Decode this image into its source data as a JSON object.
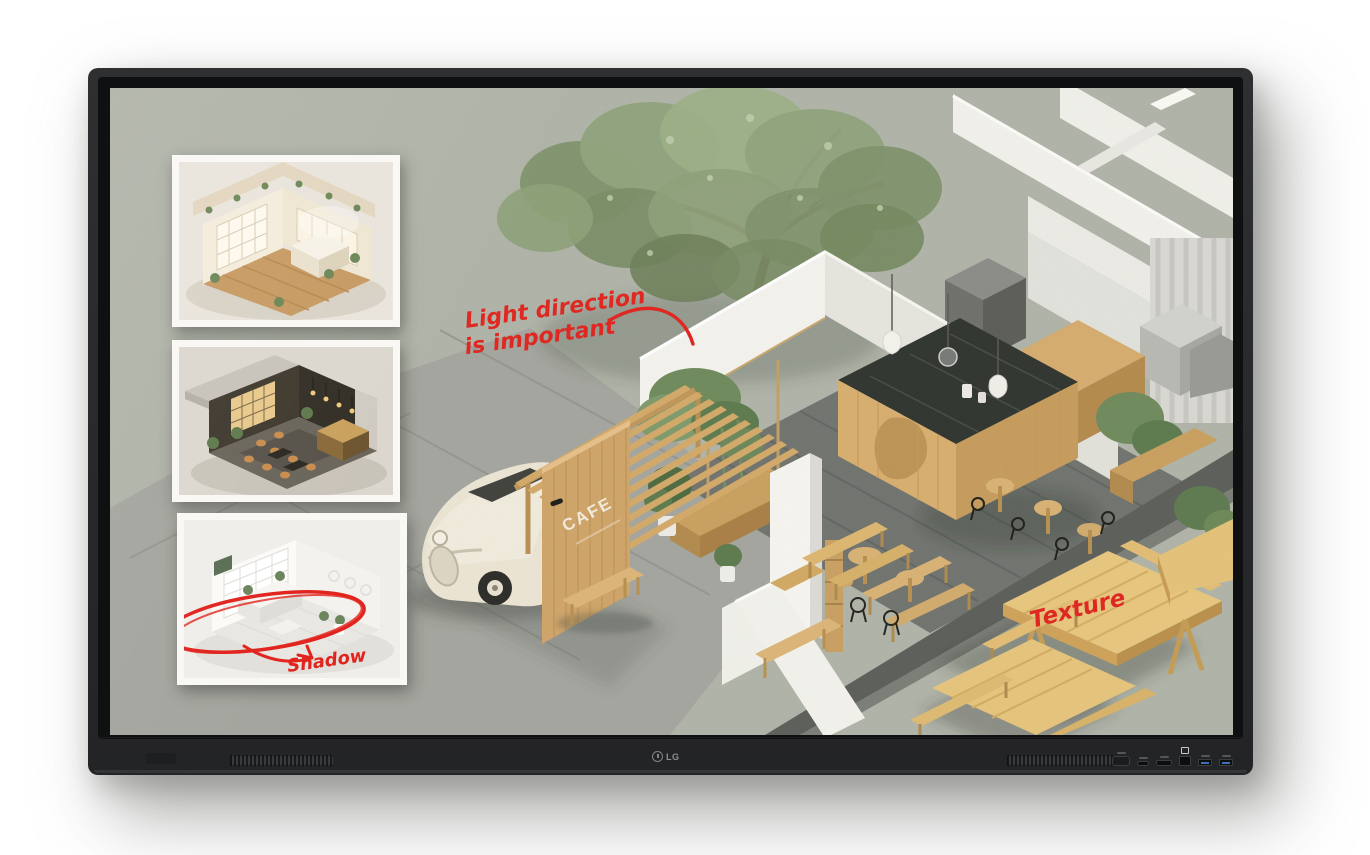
{
  "display": {
    "brand": "LG",
    "logo_text": "LG",
    "colors": {
      "bezel": "#2b2c2e",
      "chin": "#28292b"
    }
  },
  "screen": {
    "colors": {
      "background": "#b1b4a8",
      "annotation_red": "#e1241e",
      "wood": "#d8ae6e",
      "wall_white": "#f3f2ec",
      "marble_counter": "#30342f"
    },
    "cafe_sign": "CAFE",
    "annotations": {
      "light_direction_line1": "Light direction",
      "light_direction_line2": "is important",
      "texture": "Texture",
      "shadow": "Shadow"
    }
  }
}
